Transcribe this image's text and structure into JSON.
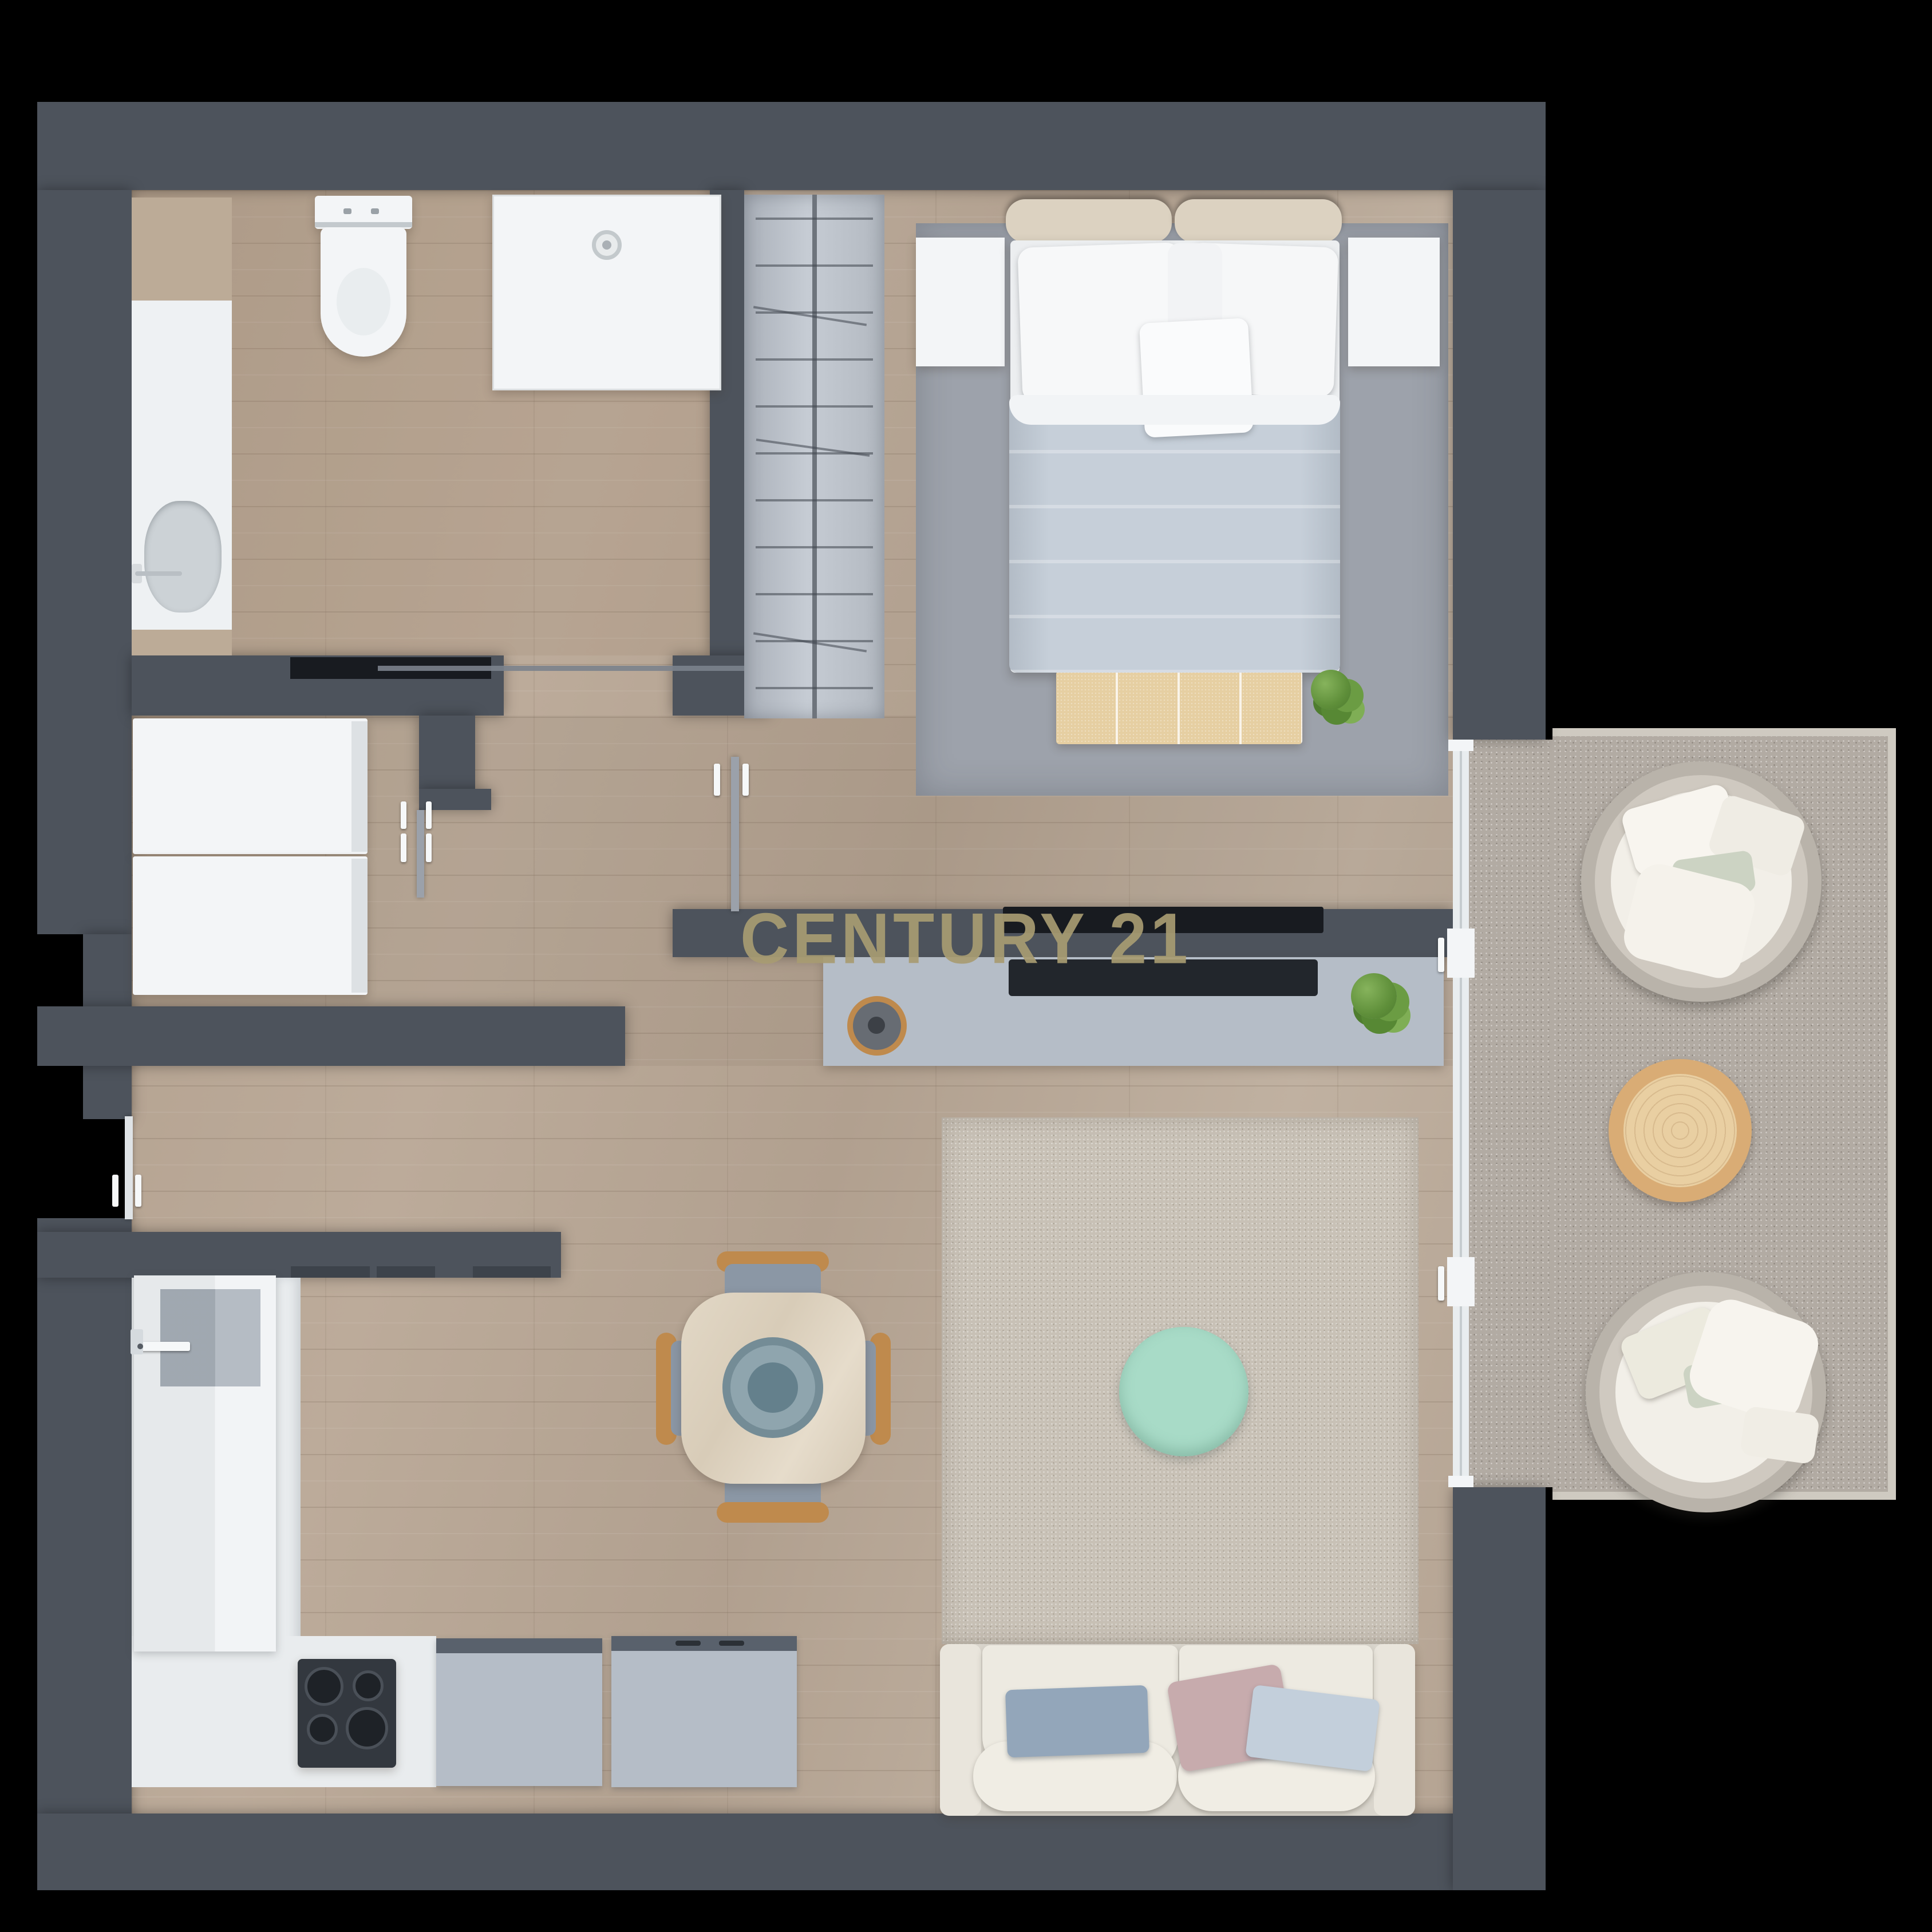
{
  "watermark": {
    "text": "CENTURY 21"
  },
  "palette": {
    "background": "#000000",
    "wall": "#4d535c",
    "floor": "#b7a695",
    "balcony": "#b2aba3",
    "rug_bedroom": "#9da2ab",
    "rug_living": "#c8c1b6",
    "mint": "#a8dbc7",
    "wood": "#bf8a4d",
    "table_wood": "#ddd2bf",
    "cream": "#e9e5dc",
    "duvet": "#c6cfd9",
    "console": "#b5bdc7",
    "fixture_white": "#f3f5f7",
    "tv_black": "#181b20",
    "plant": "#6f9c49",
    "pillow_blue": "#93a6ba",
    "pillow_pink": "#c7abad",
    "pillow_lightblue": "#c3cfdb",
    "seat_blue": "#8b97a5",
    "plate_blue": "#8fa5ae",
    "watermark": "#a89c72"
  }
}
